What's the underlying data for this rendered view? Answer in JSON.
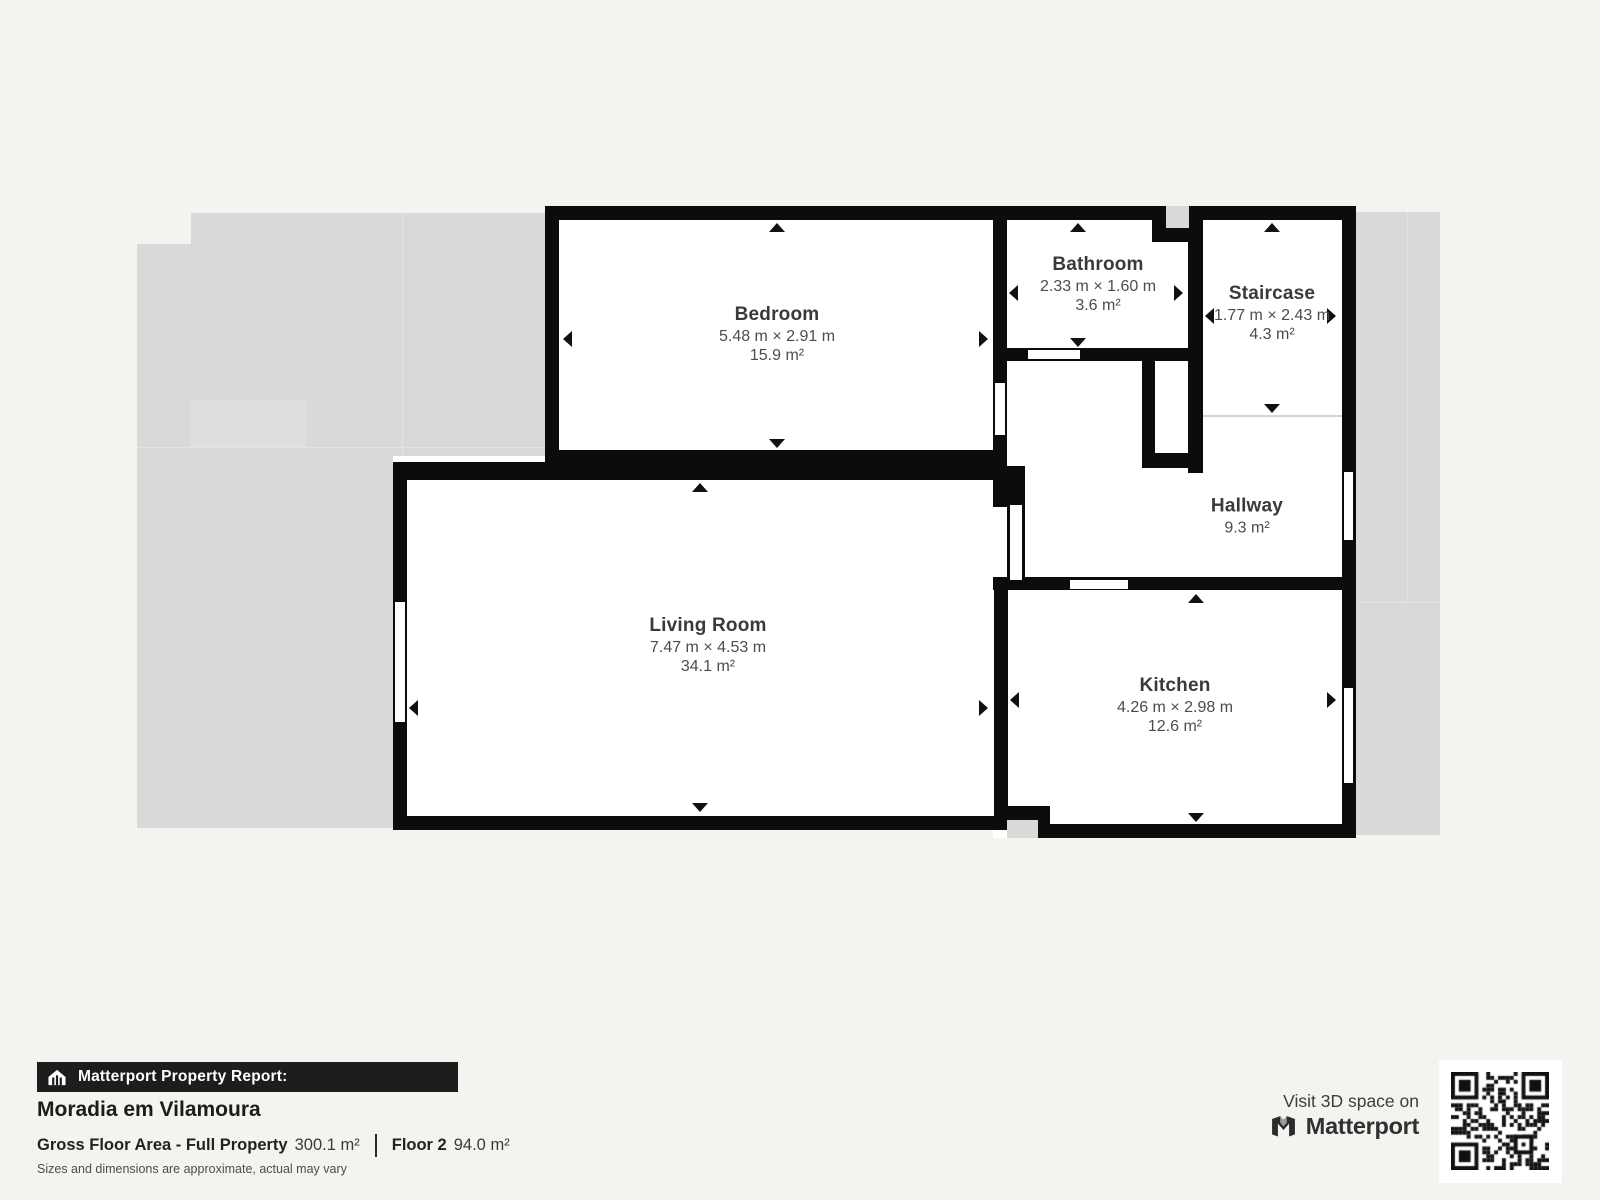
{
  "plan": {
    "rooms": [
      {
        "id": "bedroom",
        "name": "Bedroom",
        "dimensions": "5.48 m × 2.91 m",
        "area": "15.9 m²"
      },
      {
        "id": "bathroom",
        "name": "Bathroom",
        "dimensions": "2.33 m × 1.60 m",
        "area": "3.6 m²"
      },
      {
        "id": "staircase",
        "name": "Staircase",
        "dimensions": "1.77 m × 2.43 m",
        "area": "4.3 m²"
      },
      {
        "id": "hallway",
        "name": "Hallway",
        "area": "9.3 m²"
      },
      {
        "id": "living_room",
        "name": "Living Room",
        "dimensions": "7.47 m × 4.53 m",
        "area": "34.1 m²"
      },
      {
        "id": "kitchen",
        "name": "Kitchen",
        "dimensions": "4.26 m × 2.98 m",
        "area": "12.6 m²"
      }
    ]
  },
  "footer": {
    "report_label": "Matterport Property Report:",
    "property_name": "Moradia em Vilamoura",
    "gross_area_label": "Gross Floor Area - Full Property",
    "gross_area_value": "300.1 m²",
    "floor_label": "Floor 2",
    "floor_value": "94.0 m²",
    "disclaimer": "Sizes and dimensions are approximate, actual may vary"
  },
  "cta": {
    "visit_text": "Visit 3D space on",
    "brand": "Matterport"
  },
  "icons": {
    "report_badge": "house-icon",
    "brand_mark": "matterport-m-icon",
    "qr": "qr-code"
  },
  "colors": {
    "background": "#f4f3f0",
    "silhouette": "#d9d9d9",
    "wall": "#0c0c0c",
    "banner_bg": "#1d1d1d",
    "label_title": "#3a3a3a",
    "label_dims": "#4c4c4c"
  }
}
